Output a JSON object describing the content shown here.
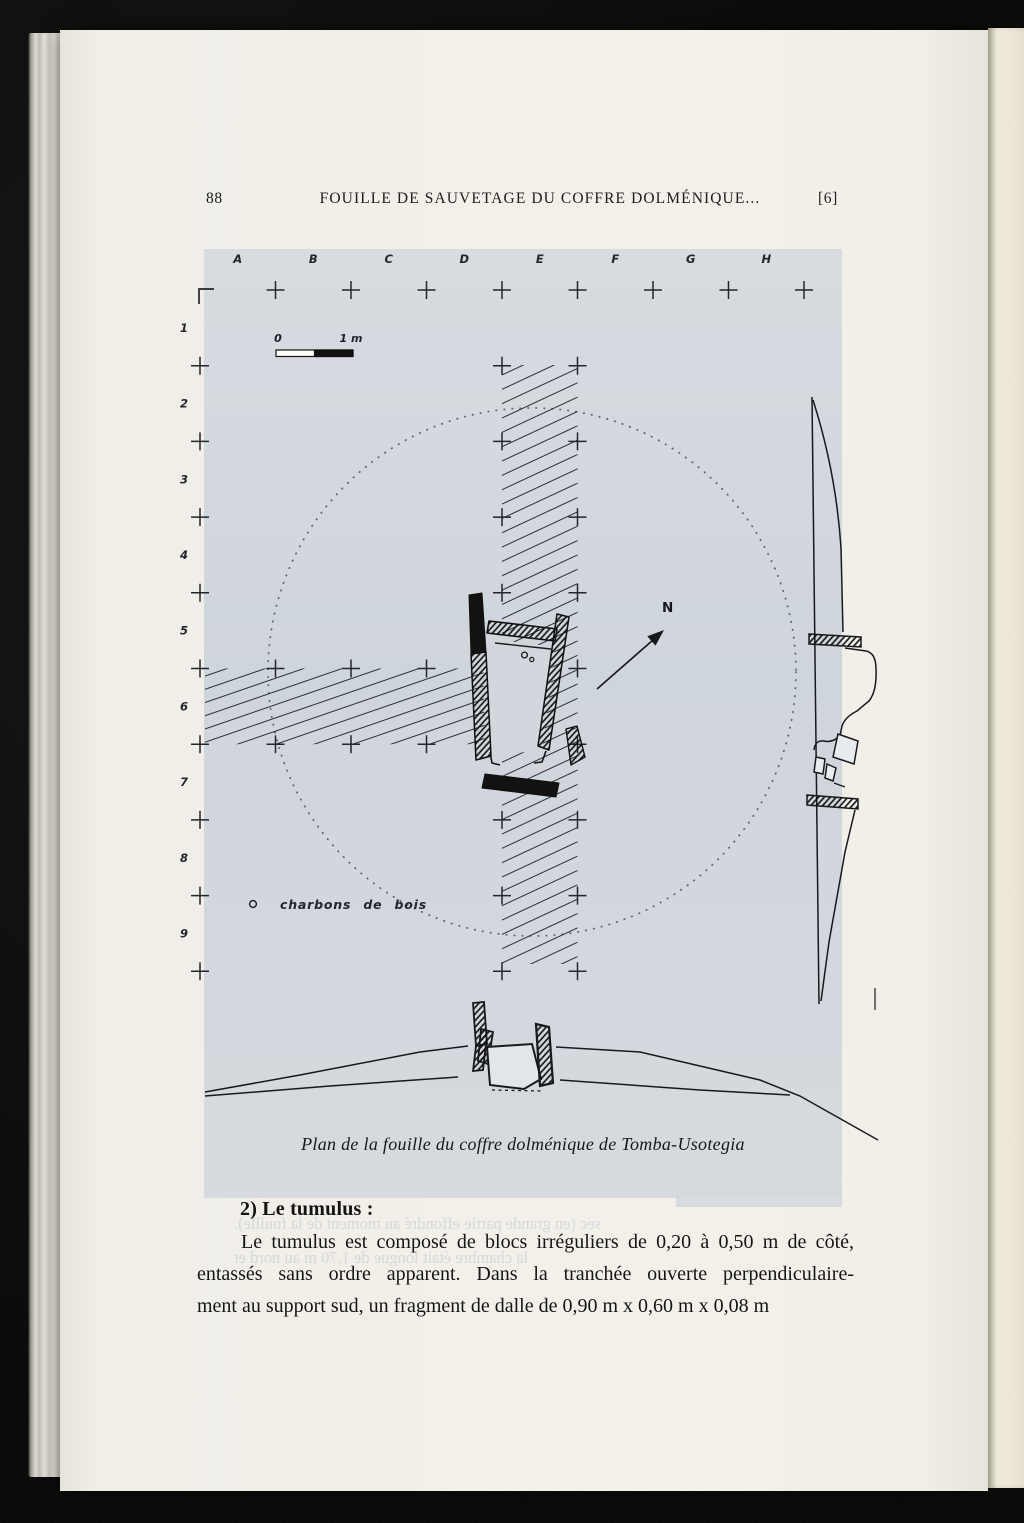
{
  "header": {
    "page_number": "88",
    "title": "FOUILLE DE SAUVETAGE DU COFFRE DOLMÉNIQUE...",
    "bracket_number": "[6]"
  },
  "figure": {
    "grid": {
      "col_letters": [
        "A",
        "B",
        "C",
        "D",
        "E",
        "F",
        "G",
        "H"
      ],
      "row_numbers": [
        "1",
        "2",
        "3",
        "4",
        "5",
        "6",
        "7",
        "8",
        "9"
      ]
    },
    "scale_bar": {
      "zero": "0",
      "one": "1 m"
    },
    "north_label": "N",
    "legend": {
      "symbol": "o",
      "label": "charbons de bois"
    },
    "caption": "Plan de la fouille du coffre dolménique de Tomba-Usotegia",
    "bleed_lines": [
      "Étude générale",
      "diamètre, sensiblement",
      "au lieu-dit Petra Basame. Per",
      "il se trouvait dans la limite, entre",
      "le tumulus recouvrait 5 à 10 cm sous",
      "et différents éléments pour celui-ci",
      "upport sud est quasiment vertical tand",
      "chement incliné vers l'intérieur de la",
      "Les supports latéraux furent placés",
      "s le sous-sol, que nous avons pu observer lors de la fouille du tumulus",
      "particulier, car dans la chambre, la couche archéologique avait, semble-t-il,",
      "traversée par les intrusions de racines. Ces handicaps devaient",
      "environ 30 cm de large et permettant un accès. L'autre du",
      "support sud, et n'avaient subi que des déprédations étaient",
      "de l'érosion, le glissement de terrain; le tout acheva et",
      "fouilles anciennes",
      "sec (en grande partie effondré au moment de la fouille).",
      "la chambre était longue de 1,70 m au nord et"
    ]
  },
  "section": {
    "heading": "2) Le tumulus :",
    "lines": [
      "Le tumulus est composé de blocs irréguliers de 0,20 à 0,50 m de côté,",
      "entassés sans ordre apparent. Dans la tranchée ouverte perpendiculaire-",
      "ment au support sud, un fragment de dalle de 0,90 m x 0,60 m x 0,08 m"
    ]
  },
  "colors": {
    "page": "#f1efe8",
    "panel": "#d3d8de",
    "ink": "#1b1b1b",
    "bleed": "#8ba0ba",
    "background": "#0b0b0a"
  }
}
